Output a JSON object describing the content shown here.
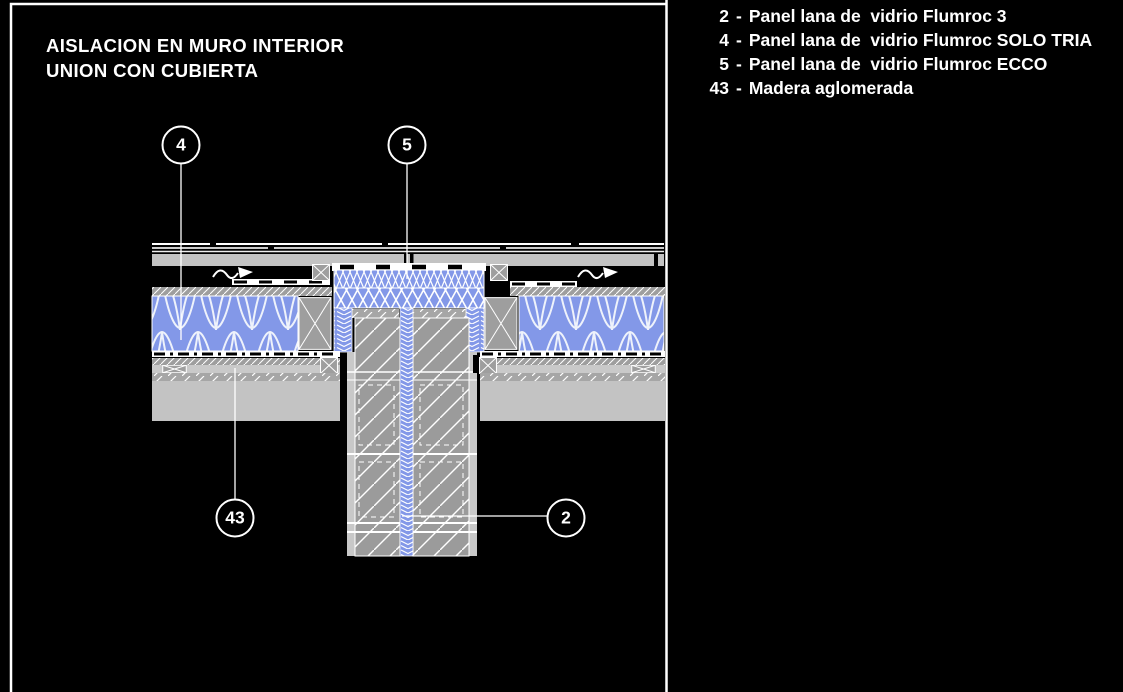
{
  "title": {
    "line1": "AISLACION EN MURO INTERIOR",
    "line2": "UNION CON CUBIERTA"
  },
  "legend": {
    "items": [
      {
        "num": "2",
        "sep": "-",
        "label": "Panel lana de  vidrio Flumroc 3"
      },
      {
        "num": "4",
        "sep": "-",
        "label": "Panel lana de  vidrio Flumroc SOLO TRIA"
      },
      {
        "num": "5",
        "sep": "-",
        "label": "Panel lana de  vidrio Flumroc ECCO"
      },
      {
        "num": "43",
        "sep": "-",
        "label": "Madera aglomerada"
      }
    ]
  },
  "callouts": [
    {
      "num": "4"
    },
    {
      "num": "5"
    },
    {
      "num": "43"
    },
    {
      "num": "2"
    }
  ],
  "colors": {
    "background": "#000000",
    "linework": "#ffffff",
    "insulation_blue": "#8398e8",
    "structure_gray": "#9b9b9b",
    "board_light_gray": "#c3c3c3",
    "edge_gray": "#c8c8c8"
  }
}
